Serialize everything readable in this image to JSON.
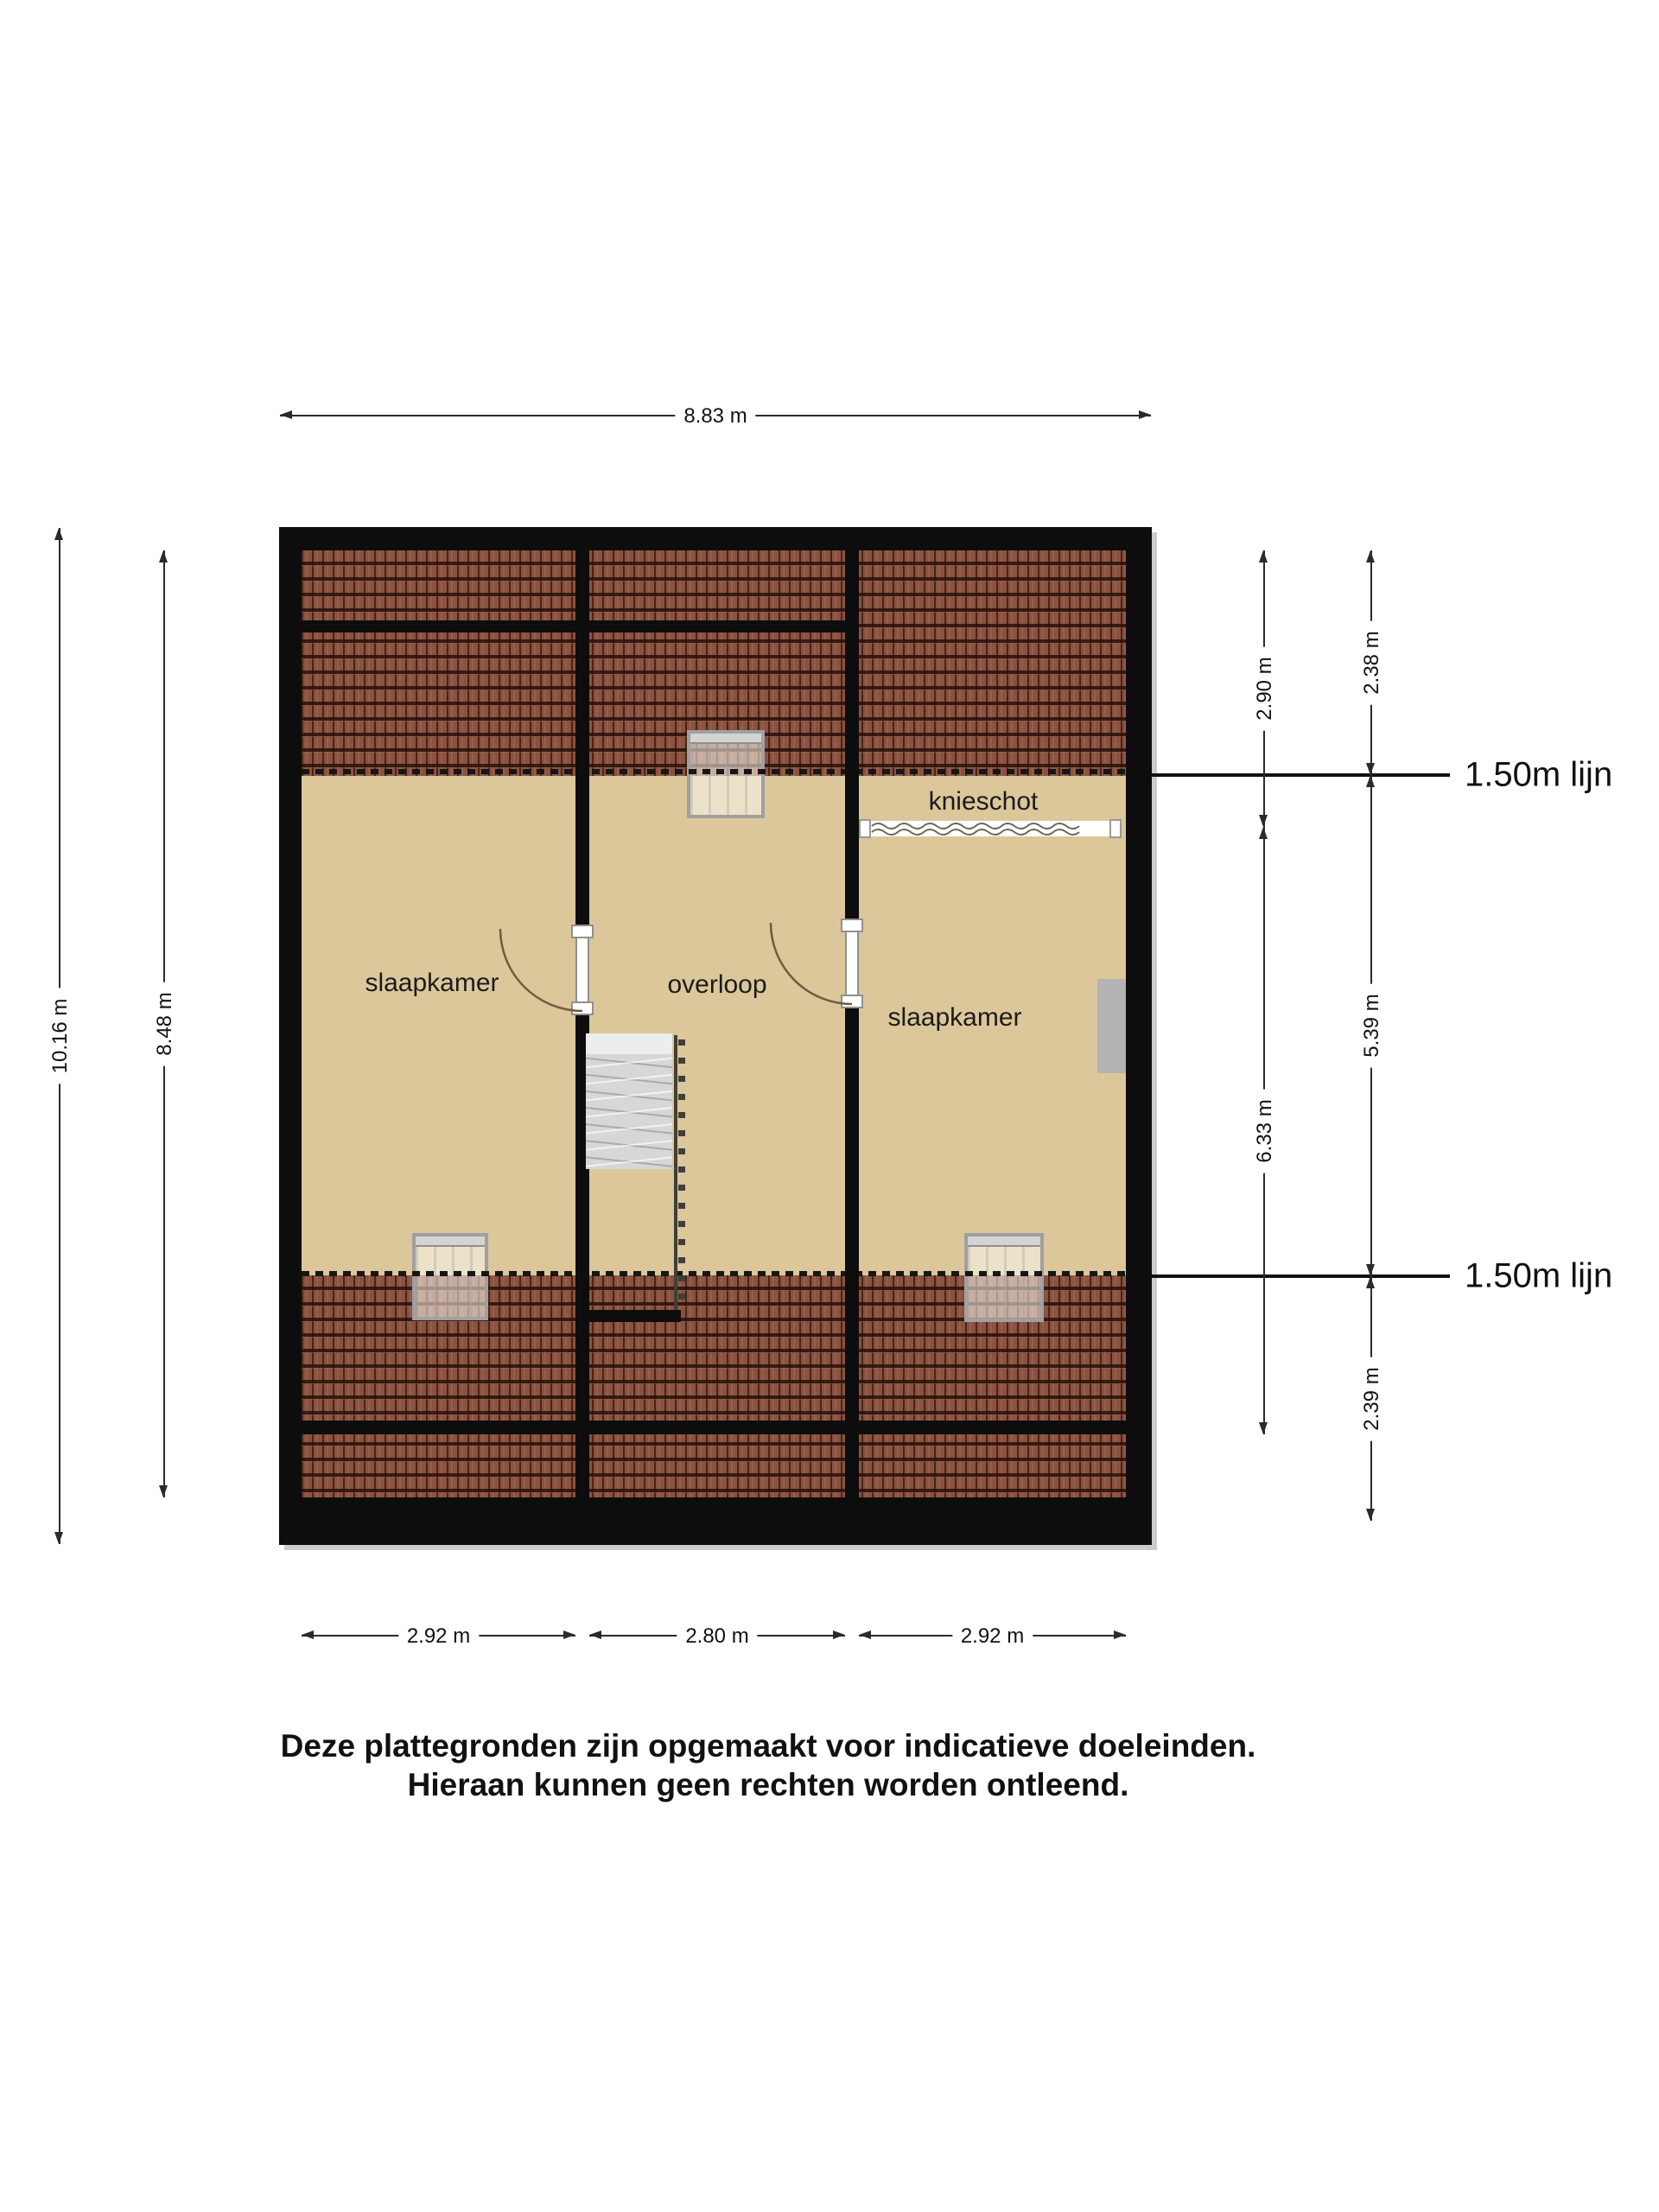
{
  "rooms": {
    "bedroom_left": "slaapkamer",
    "landing": "overloop",
    "bedroom_right": "slaapkamer",
    "knee_wall": "knieschot"
  },
  "dimensions": {
    "top_width": "8.83 m",
    "left_outer_height": "10.16 m",
    "left_inner_height": "8.48 m",
    "right_inner_top": "2.90 m",
    "right_inner_bottom": "6.33 m",
    "right_outer_top": "2.38 m",
    "right_outer_middle": "5.39 m",
    "right_outer_bottom": "2.39 m",
    "bottom_left": "2.92 m",
    "bottom_middle": "2.80 m",
    "bottom_right": "2.92 m"
  },
  "reference_lines": {
    "top": "1.50m lijn",
    "bottom": "1.50m lijn"
  },
  "disclaimer": {
    "line1": "Deze plattegronden zijn opgemaakt voor indicatieve doeleinden.",
    "line2": "Hieraan kunnen geen rechten worden ontleend."
  },
  "colors": {
    "wall": "#0d0d0d",
    "floor": "#dcc79b",
    "roof_tile": "#8a5240",
    "roof_tile_dark": "#2d120c",
    "dimension_line": "#2b2b2b",
    "stairs": "#d6d8d8",
    "skylight_frame": "#a0a0a0",
    "furniture_grey": "#b3b3b3"
  }
}
